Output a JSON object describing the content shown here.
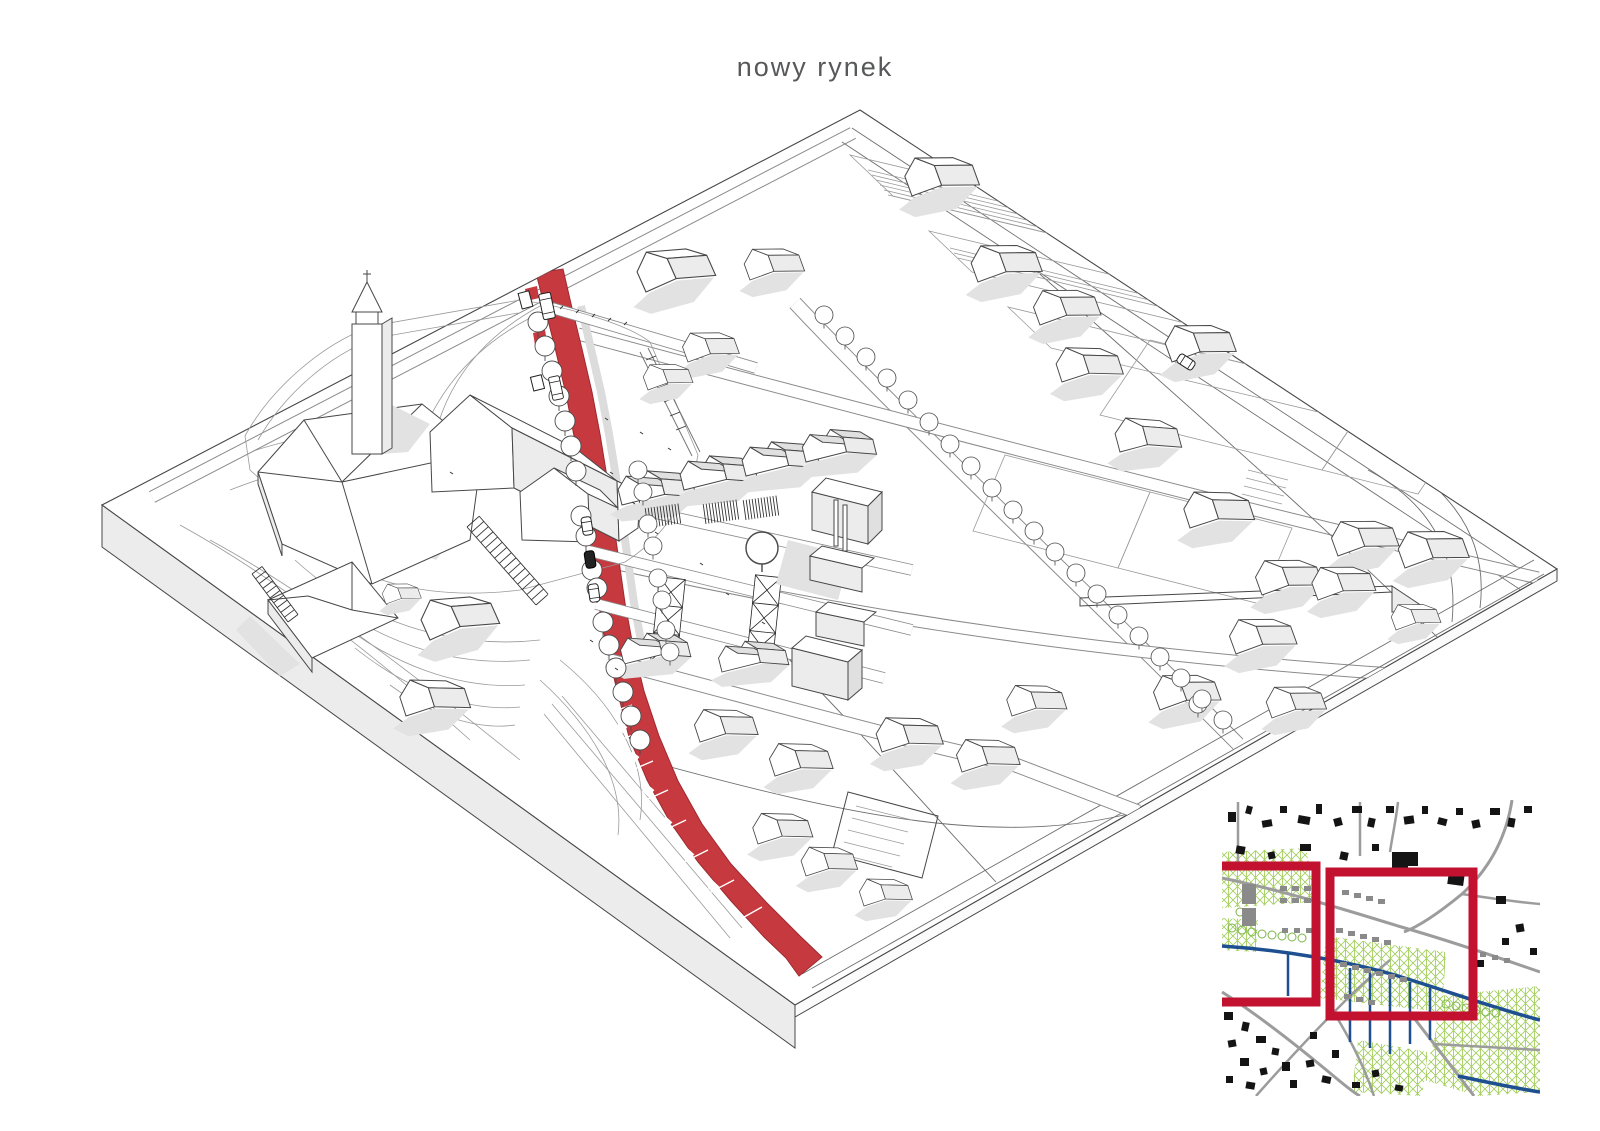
{
  "title": {
    "text": "nowy rynek"
  },
  "colors": {
    "title_gray": "#57585a",
    "accent_red": "#c6393f",
    "accent_red_stroke": "#9c2a30",
    "line_dark": "#474747",
    "shadow_gray": "#e2e2e2",
    "side_gray": "#ececec",
    "inset_frame_red": "#c2122f",
    "inset_road_gray": "#9c9c9c",
    "inset_green": "#a5cf60",
    "inset_blue": "#1d4f91",
    "inset_building_black": "#141414",
    "inset_block_gray": "#8a8a8a"
  }
}
